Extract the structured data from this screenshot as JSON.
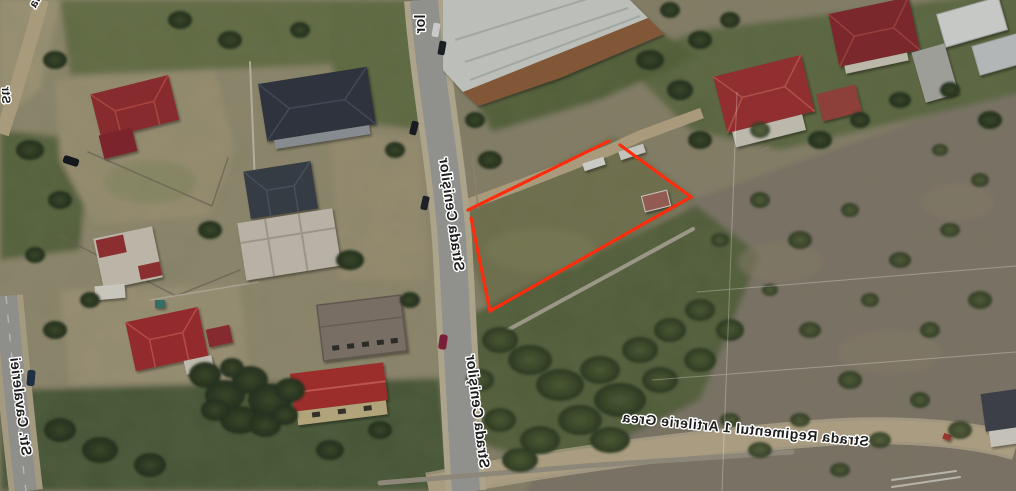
{
  "map": {
    "streets": {
      "main_upper": "Strada Cenişilor",
      "main_lower": "Strada Cenişilor",
      "main_top_partial": "lor",
      "left": "Str. Cavaleriei",
      "bottom": "Strada Regimentul 1 Artilerie Grea",
      "top_left_fragment": "la",
      "left_edge_fragment": "Str"
    },
    "parcel": {
      "outline_color": "#fe2c0d",
      "vertices_px": [
        [
          468,
          212
        ],
        [
          614,
          140
        ],
        [
          691,
          197
        ],
        [
          490,
          311
        ]
      ],
      "gap_at_top_vertex": true
    },
    "palette": {
      "label_ink": "#1d1d1d",
      "label_halo": "#ffffff",
      "asphalt": "#a6a6a2",
      "dirt_road": "#c4b493",
      "red_roof": "#a03338",
      "dark_roof": "#343b46",
      "field_mauve": "#8d8174",
      "scrub_green": "#4c5c36"
    }
  }
}
